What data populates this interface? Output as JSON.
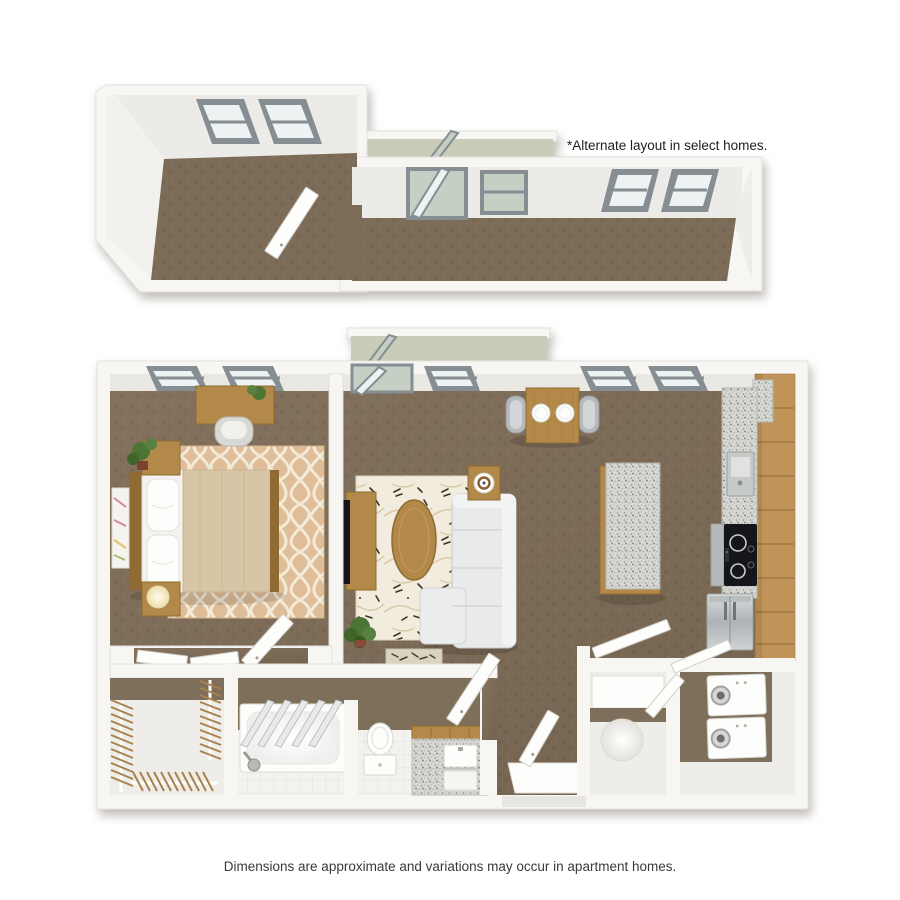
{
  "texts": {
    "alternate_note": "*Alternate layout in select homes.",
    "disclaimer": "Dimensions are approximate and variations may occur in apartment homes."
  },
  "colors": {
    "background": "#ffffff",
    "wall": "#f7f6f3",
    "wall_face": "#eae8e3",
    "balcony": "#c9ccb9",
    "window_frame": "#868d93",
    "glass": "#edf2f2",
    "glass_green": "#c6cfc4",
    "carpet": "#7d6c58",
    "wood": "#b38949",
    "wood_dark": "#8f6a33",
    "wood_light": "#c09459",
    "door": "#fdfdfc",
    "brown_wall": "#7e6f5a",
    "light_floor": "#efede9",
    "sofa": "#e9eaec",
    "granite": "#d6d6d3",
    "rug_tan": "#debd98",
    "rug_pattern": "#f3ead8",
    "rug_living": "#f1ecdd",
    "leaf": "#3b3428",
    "plant": "#4c7434",
    "tv": "#141417",
    "blanket": "#d8c5a6"
  }
}
